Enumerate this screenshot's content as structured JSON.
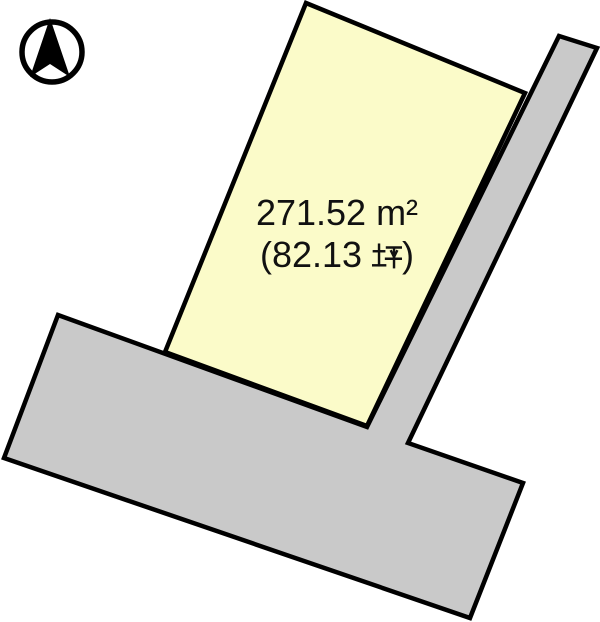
{
  "page": {
    "width": 600,
    "height": 622,
    "background": "#ffffff"
  },
  "colors": {
    "parcel_fill": "#fbfbc9",
    "road_fill": "#c9c9c9",
    "outline": "#000000",
    "text": "#111111"
  },
  "compass": {
    "icon": "north-arrow-icon"
  },
  "site_plan": {
    "parcel": {
      "area_m2": "271.52 m²",
      "area_tsubo": "(82.13 坪)",
      "area_tsubo_open": "(82.13 ",
      "area_tsubo_unit": "坪",
      "area_tsubo_close": ")",
      "points": "306,3 525,93 367,426 165,352"
    },
    "roads": {
      "points": "559,36 597,48 408,443 523,483 470,618 4,458 58,315 367,427"
    }
  }
}
